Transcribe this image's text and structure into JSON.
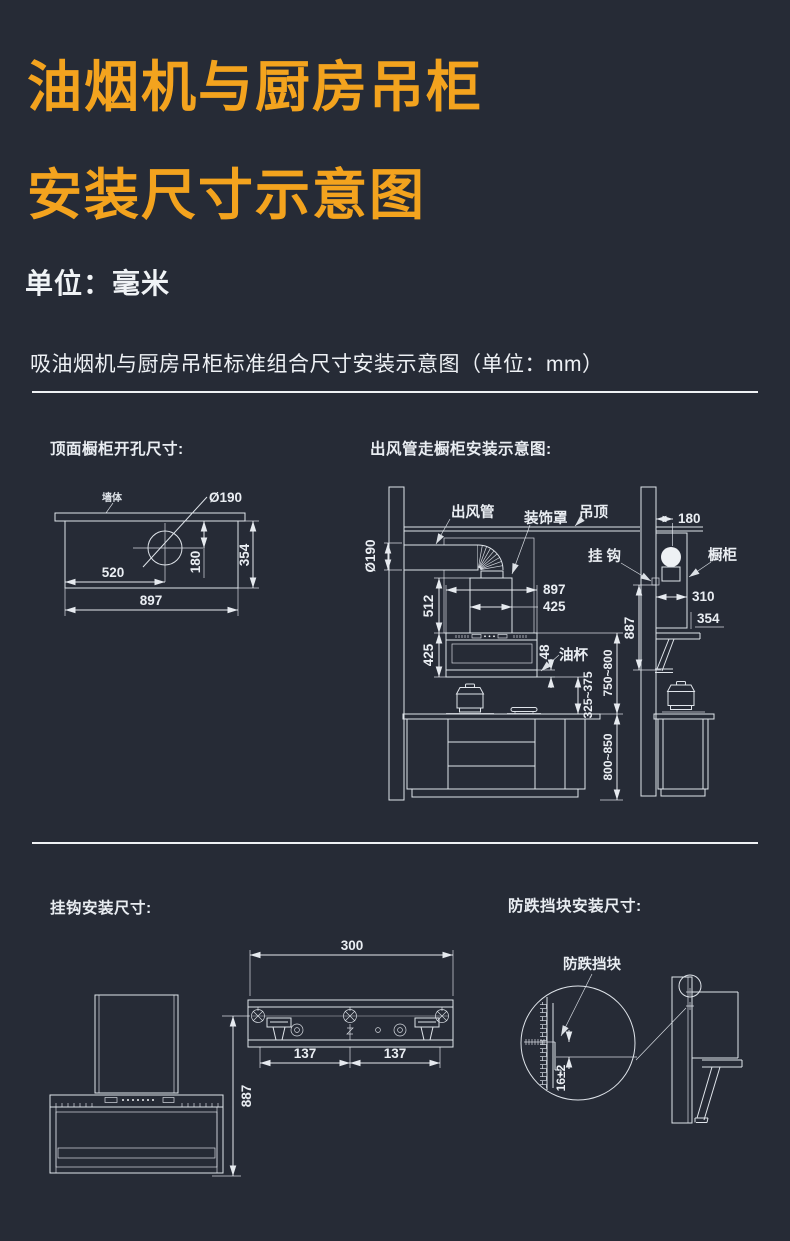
{
  "page": {
    "background": "#262b36",
    "accent_color": "#f3a31e",
    "line_color": "#dfe4ea"
  },
  "header": {
    "title_line1": "油烟机与厨房吊柜",
    "title_line2": "安装尺寸示意图",
    "unit_note": "单位：毫米",
    "subtitle": "吸油烟机与厨房吊柜标准组合尺寸安装示意图（单位：mm）"
  },
  "tl": {
    "title": "顶面橱柜开孔尺寸:",
    "wall_label": "墙体",
    "hole_dia": "Ø190",
    "d520": "520",
    "d897": "897",
    "d180": "180",
    "d354": "354"
  },
  "tr": {
    "title": "出风管走橱柜安装示意图:",
    "duct_dia": "Ø190",
    "duct_label": "出风管",
    "cover_label": "装饰罩",
    "ceiling_label": "吊顶",
    "hook_label": "挂钩",
    "cabinet_label": "橱柜",
    "oilcup_label": "油杯",
    "d512": "512",
    "d425h": "425",
    "d897": "897",
    "d425w": "425",
    "d48": "48",
    "d325": "325~375",
    "d750": "750~800",
    "d800": "800~850",
    "d887": "887",
    "d180": "180",
    "d310": "310",
    "d354": "354"
  },
  "bl": {
    "title": "挂钩安装尺寸:",
    "d300": "300",
    "d137a": "137",
    "d137b": "137",
    "d887": "887"
  },
  "br": {
    "title": "防跌挡块安装尺寸:",
    "block_label": "防跌挡块",
    "d16": "16±2"
  }
}
